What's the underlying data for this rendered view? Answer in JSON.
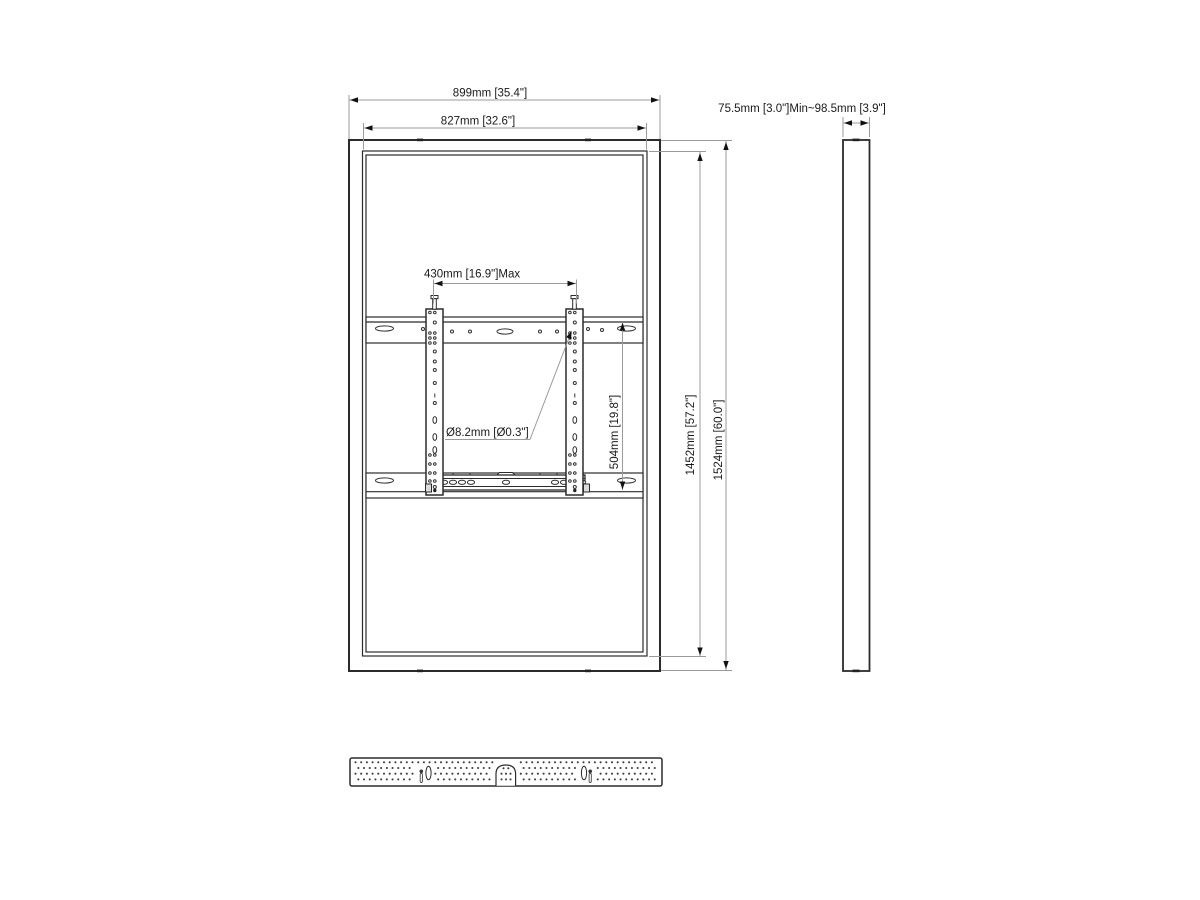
{
  "drawing": {
    "front_view": {
      "outer_width": "899mm [35.4\"]",
      "inner_width": "827mm [32.6\"]",
      "inner_height": "1452mm [57.2\"]",
      "outer_height": "1524mm [60.0\"]",
      "bracket_width": "430mm [16.9\"]Max",
      "hole_diameter": "Ø8.2mm [Ø0.3\"]",
      "bracket_height": "504mm [19.8\"]"
    },
    "side_view": {
      "depth_range": "75.5mm [3.0\"]Min~98.5mm [3.9\"]"
    },
    "colors": {
      "part_line": "#2b2b2b",
      "dimension_line": "#9b9b9b",
      "text": "#1a1a1a",
      "background": "#ffffff"
    }
  }
}
